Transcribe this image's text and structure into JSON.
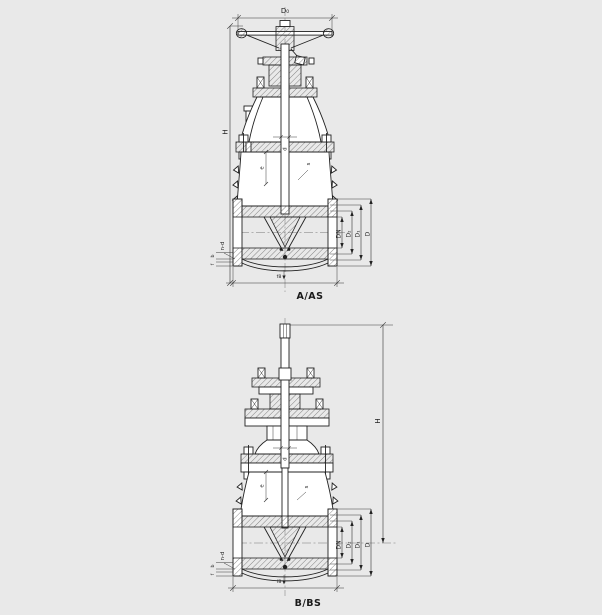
{
  "background_color": "#e9e9e9",
  "line_color": "#222222",
  "valve_top": {
    "caption": "A/AS",
    "dims": {
      "handwheel_diameter": "D₀",
      "height": "H",
      "stem_diameter": "d",
      "label_e": "e",
      "label_s": "s",
      "bolt_holes": "n-d",
      "flange_thickness": "b",
      "raised_face_height": "f",
      "nominal_bore": "DN",
      "raised_face_diameter": "D₂",
      "bolt_circle_diameter": "D₁",
      "flange_outer_diameter": "D",
      "face_mark": "f8"
    }
  },
  "valve_bottom": {
    "caption": "B/BS",
    "dims": {
      "height": "H",
      "stem_diameter": "d",
      "label_e": "e",
      "label_s": "s",
      "bolt_holes": "n-d",
      "flange_thickness": "b",
      "raised_face_height": "f",
      "nominal_bore": "DN",
      "raised_face_diameter": "D₂",
      "bolt_circle_diameter": "D₁",
      "flange_outer_diameter": "D",
      "face_mark": "f8"
    }
  }
}
